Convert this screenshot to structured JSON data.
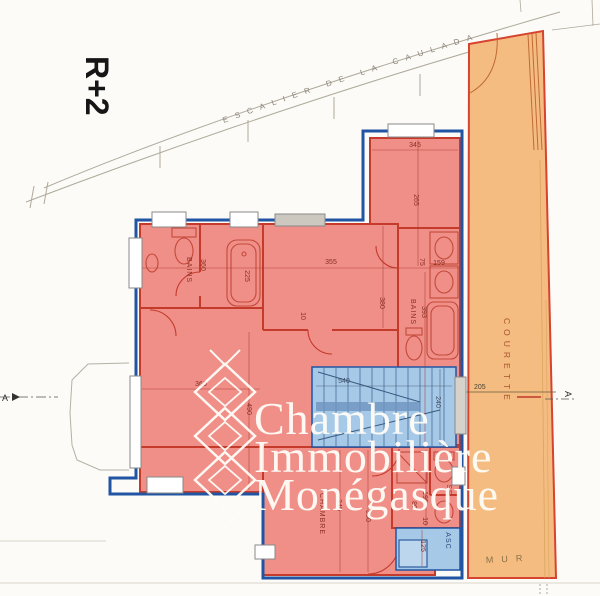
{
  "labels": {
    "floor": "R+2",
    "street": "ESCALIER DE LA CAULADA",
    "courette": "COURETTE",
    "wall": "MUR",
    "section_left": "A",
    "section_right": "A",
    "bains_left": "BAINS",
    "bains_right": "BAINS",
    "chambre": "CHAMBRE",
    "shower_room": "SE",
    "elevator": "ASC"
  },
  "watermark": {
    "line1": "Chambre",
    "line2": "Immobilière",
    "line3": "Monégasque"
  },
  "dimensions": {
    "bains_left_width": "360",
    "bathtub_length": "225",
    "wall_offset_upper": "10",
    "living_width": "355",
    "living_depth": "380",
    "top_room_width": "345",
    "top_room_depth": "265",
    "top_room_door": "75",
    "bains_right_width": "159",
    "bains_right_depth": "393",
    "stair_width": "540",
    "stair_depth": "240",
    "dressing_width": "360",
    "dressing_depth": "490",
    "chambre_width": "345",
    "chambre_depth": "330",
    "shower_room_depth": "195",
    "shower_room_width": "80",
    "wall_offset_lower": "10",
    "elevator_width": "125",
    "courette_width": "205"
  },
  "colors": {
    "room_fill_red": "#ef8f88",
    "wall_red": "#c43a2b",
    "stair_fill_blue": "#a6c9e8",
    "outline_blue": "#2155a3",
    "courette_fill": "#f4bc81",
    "courette_border": "#d6432f",
    "pencil_gray": "#b0a99c",
    "paper": "#fcfbf7"
  }
}
